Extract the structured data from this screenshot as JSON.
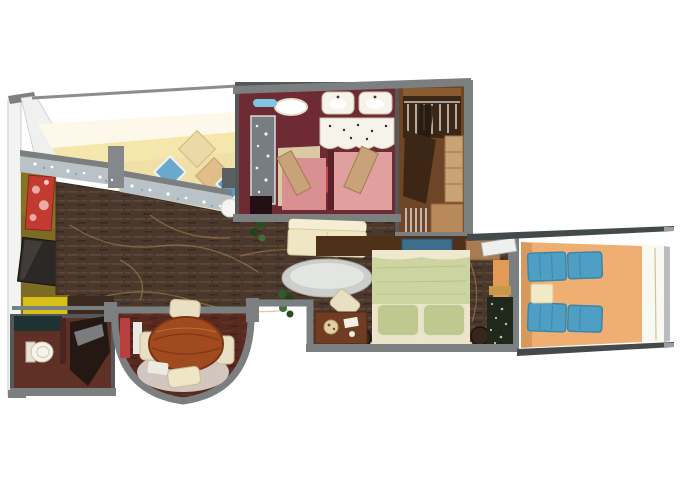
{
  "meta": {
    "title": "3D rendered cruise-suite floor plan",
    "view": "isometric top-down cutaway",
    "visible_text": ""
  },
  "palette": {
    "background": "#ffffff",
    "wall_gray": "#7b7f80",
    "wall_dark": "#54585a",
    "wall_white": "#f3f4f1",
    "ceiling_cream": "#fdf8ea",
    "wall_yellow": "#f5e7ac",
    "nook_floor": "#f0dfa6",
    "olive_wall": "#7c6b22",
    "accent_yellow": "#d6c019",
    "artwork_red": "#c23b31",
    "artwork_pink": "#eda9a4",
    "tv_black": "#2c2825",
    "carpet_brown": "#4b382c",
    "carpet_streak": "#6d5442",
    "carpet_line": "#bb9257",
    "glass_counter": "#b9c3c7",
    "bathroom_wall": "#6f2b33",
    "bathroom_floor": "#dbc9a3",
    "stall_pink": "#d89090",
    "stall_red": "#c04a4e",
    "fixture_white": "#f6f3ea",
    "shower_glass": "#777d80",
    "towel_blue": "#7fc6e4",
    "closet_brown": "#6f4527",
    "closet_dark": "#3c2716",
    "closet_shelf": "#c9a276",
    "bed_green": "#ccd4a2",
    "pillow_green": "#bdc98e",
    "bed_cream": "#ece4cb",
    "console_brown": "#4f3119",
    "tv_screen_blue": "#3e6e8e",
    "nightstand_brown": "#713d22",
    "balcony_floor": "#efae72",
    "lounger_blue": "#4f9fc4",
    "lounger_blue_dark": "#3a86aa",
    "deck_white": "#f9f9f4",
    "rail_gray": "#44494b",
    "sofa_cream": "#efe6c4",
    "table_silver": "#cccecb",
    "dining_table_wood": "#a04a1f",
    "chair_cream": "#e9dfc2",
    "dining_floor": "#58291f",
    "powder_floor": "#5e3026",
    "counter_teal": "#1d3232",
    "plant_green": "#2e5b2a",
    "door_tan": "#c8a278",
    "curtain_dark": "#20281c",
    "glow_orange": "#e29a55"
  },
  "rooms": [
    {
      "id": "living-room",
      "label": "living room"
    },
    {
      "id": "window-nook",
      "label": "window seating nook"
    },
    {
      "id": "master-bathroom",
      "label": "master bathroom"
    },
    {
      "id": "walk-in-closet",
      "label": "walk-in closet"
    },
    {
      "id": "bedroom",
      "label": "bedroom"
    },
    {
      "id": "balcony",
      "label": "balcony"
    },
    {
      "id": "powder-room",
      "label": "powder room"
    },
    {
      "id": "dining-bay",
      "label": "dining bay"
    }
  ],
  "furniture": [
    "glass bar counters",
    "wall art",
    "flat tv",
    "sofa",
    "oval coffee table",
    "desk with tray",
    "round dining table",
    "four dining chairs",
    "jacuzzi tub",
    "double sinks",
    "glass shower",
    "toilet stalls",
    "hanging clothes",
    "shelves",
    "bench",
    "double bed",
    "pillows",
    "tv console",
    "nightstands",
    "two blue loungers",
    "balcony side table",
    "white railing",
    "toilet",
    "wash basin",
    "plants",
    "sphere vase"
  ]
}
